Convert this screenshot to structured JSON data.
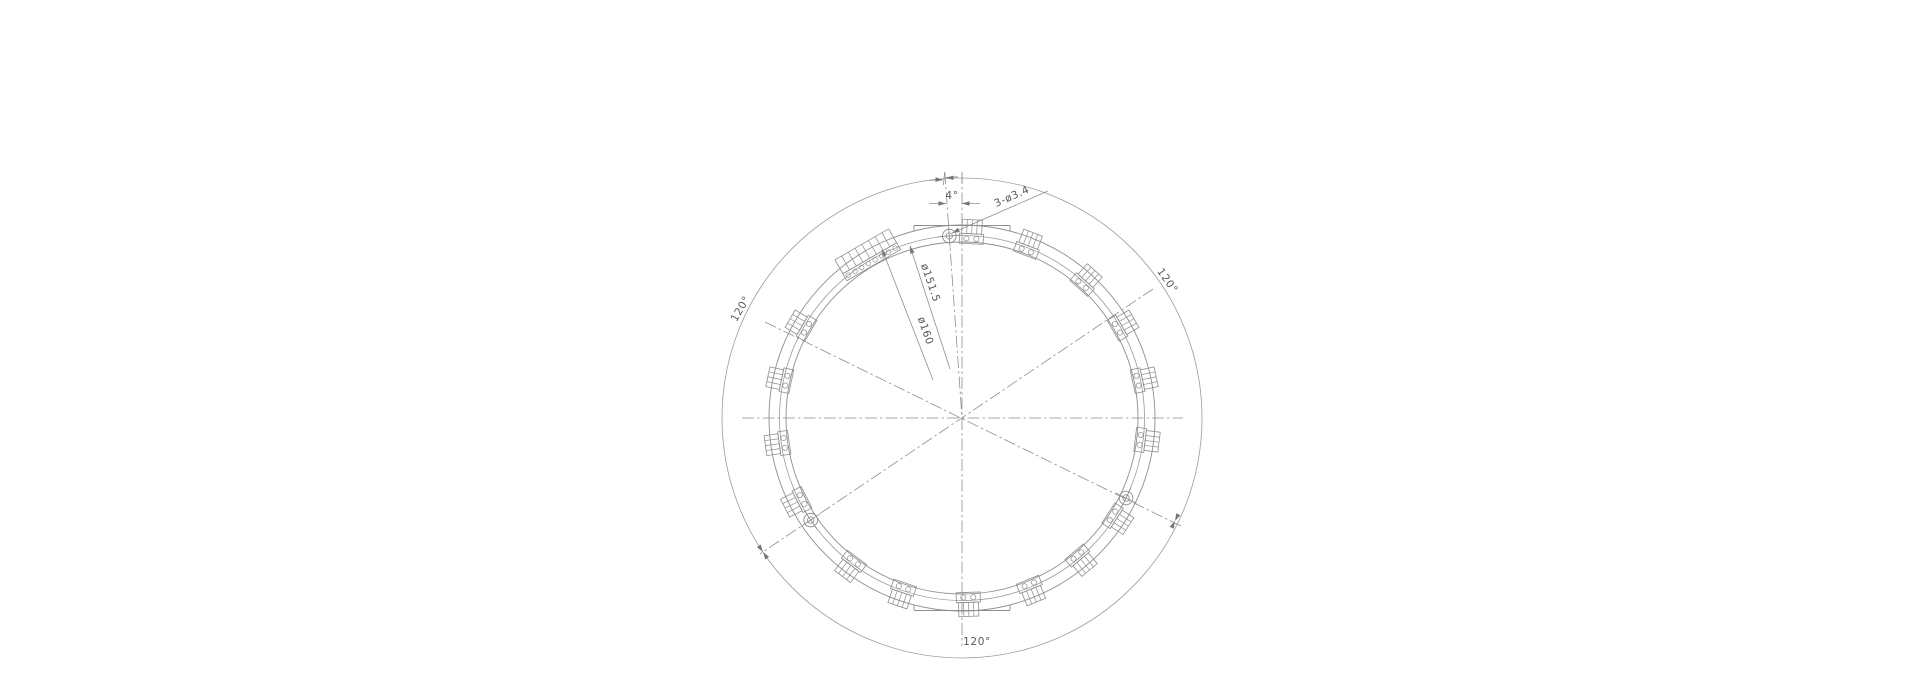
{
  "drawing": {
    "title": "circular-flex-pcb-ring-drawing",
    "labels": {
      "angle_offset": "4°",
      "hole_spec": "3-ø3.4",
      "bolt_circle_dia": "ø151.5",
      "outer_dia": "ø160",
      "spacing_1": "120°",
      "spacing_2": "120°",
      "spacing_3": "120°"
    },
    "colors": {
      "line": "#8e8e8e",
      "thin_line": "#9b9b9b",
      "arrow": "#757575",
      "text": "#585858",
      "background": "#ffffff"
    },
    "geometry": {
      "cx": 962,
      "cy": 418,
      "r_dim_circle": 240,
      "r_ring_outer": 193,
      "r_bolt_circle": 182.5,
      "r_ring_inner": 176,
      "holes_deg": [
        356,
        116,
        236
      ],
      "hole_outer_r": 6.8,
      "hole_inner_r": 3.2,
      "hole_cross": 11.5,
      "blocks_deg": [
        3,
        21,
        42,
        60,
        78,
        97,
        123,
        140,
        158,
        178,
        199,
        217,
        243,
        262,
        282,
        300
      ],
      "block_radius": 185.5,
      "long_block_deg": 330,
      "long_block_radius": 186.5,
      "flat_half_width": 48,
      "flat_top_y": 225.5,
      "flat_bottom_y": 610.5,
      "centerlines": [
        [
          962,
          172,
          962,
          646
        ],
        [
          742,
          418,
          1183,
          418
        ],
        [
          1153,
          289,
          760,
          554
        ],
        [
          765,
          322,
          1183,
          527
        ],
        [
          944.8,
          172,
          962,
          418
        ]
      ],
      "dash_pattern": "12 3 2.5 3",
      "leader_lines": [
        [
          910,
          246,
          950,
          369
        ],
        [
          882,
          249,
          933,
          380
        ],
        [
          952,
          233,
          1048,
          191
        ],
        [
          929,
          203.5,
          946,
          203.5
        ],
        [
          962,
          203.5,
          980,
          203.5
        ],
        [
          929,
          180.3,
          943,
          179.8
        ],
        [
          946,
          177.6,
          958,
          176.8
        ]
      ],
      "ticks": [
        [
          944.5,
          172.5,
          943.5,
          185
        ],
        [
          962,
          172.5,
          962,
          184
        ]
      ],
      "arrows": [
        {
          "x": 943,
          "y": 179.8,
          "a": 2
        },
        {
          "x": 946,
          "y": 177.6,
          "a": 182
        },
        {
          "x": 946,
          "y": 203.5,
          "a": 0
        },
        {
          "x": 962,
          "y": 203.5,
          "a": 180
        },
        {
          "x": 1175,
          "y": 521,
          "a": 116
        },
        {
          "x": 1175,
          "y": 521,
          "a": -64
        },
        {
          "x": 763,
          "y": 552,
          "a": 236
        },
        {
          "x": 763,
          "y": 552,
          "a": 56
        },
        {
          "x": 910,
          "y": 246,
          "a": -108
        },
        {
          "x": 882,
          "y": 249,
          "a": -111
        },
        {
          "x": 952,
          "y": 233,
          "a": 156
        }
      ]
    }
  }
}
